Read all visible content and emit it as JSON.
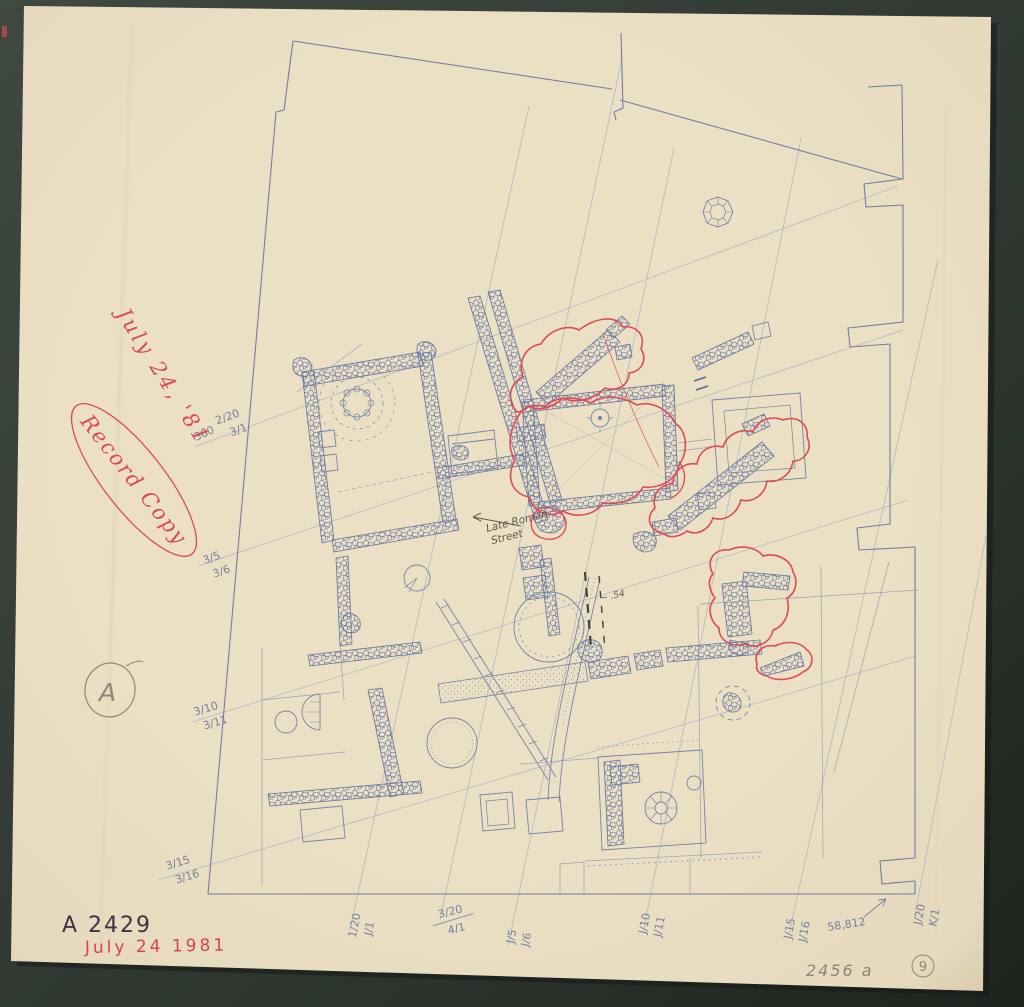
{
  "colors": {
    "background_dark": "#2a322c",
    "paper": "#ebdfc4",
    "pencil_blue": "#7080a5",
    "grid_blue": "#a9b1c9",
    "red_ink": "#dc4a56",
    "dark_ink": "#3c3442",
    "graphite": "#8d8779"
  },
  "red_annotations": {
    "date_diagonal": "July 24, '81",
    "record_copy": "Record Copy",
    "date_bottom": "July 24 1981"
  },
  "ink_annotations": {
    "negative_number": "A 2429"
  },
  "pencil_annotations": {
    "area_letter": "A",
    "bench_mark": "360",
    "elevation": "58,812",
    "street_line1": "Late Roman",
    "street_line2": "Street",
    "level_note": "~ .54",
    "page_ref": "2456 a",
    "sheet_number": "9"
  },
  "grid_labels": {
    "left": [
      {
        "top": "2/20",
        "bottom": "3/1"
      },
      {
        "top": "3/5",
        "bottom": "3/6"
      },
      {
        "top": "3/10",
        "bottom": "3/11"
      },
      {
        "top": "3/15",
        "bottom": "3/16"
      }
    ],
    "bottom": [
      {
        "top": "1/20",
        "bottom": "J/1"
      },
      {
        "top": "3/20",
        "bottom": "4/1"
      },
      {
        "top": "J/5",
        "bottom": "J/6"
      },
      {
        "top": "J/10",
        "bottom": "J/11"
      },
      {
        "top": "J/15",
        "bottom": "J/16"
      },
      {
        "top": "J/20",
        "bottom": "K/1"
      }
    ]
  }
}
